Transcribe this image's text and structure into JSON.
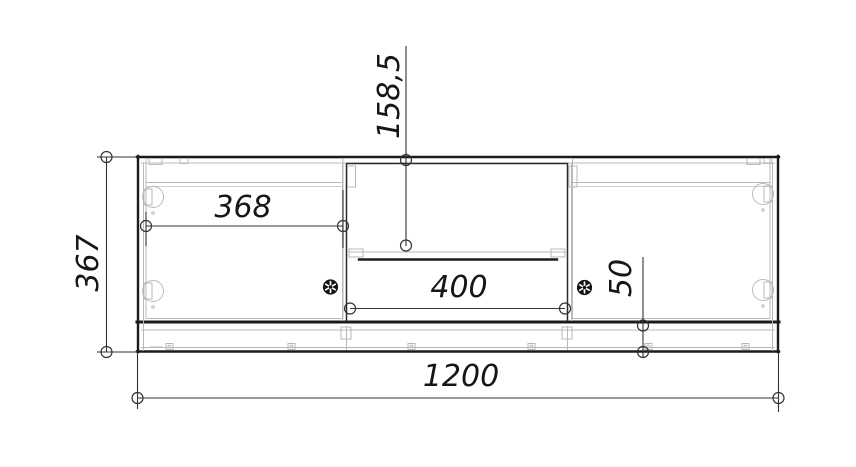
{
  "drawing": {
    "dim": {
      "overall_width": "1200",
      "overall_height": "367",
      "door_width": "368",
      "niche_height": "158,5",
      "drawer_width": "400",
      "plinth_height": "50"
    },
    "colors": {
      "outline": "#1b1b1b",
      "detail_gray": "#b9b9b9",
      "dimension": "#333333",
      "background": "#ffffff"
    }
  }
}
